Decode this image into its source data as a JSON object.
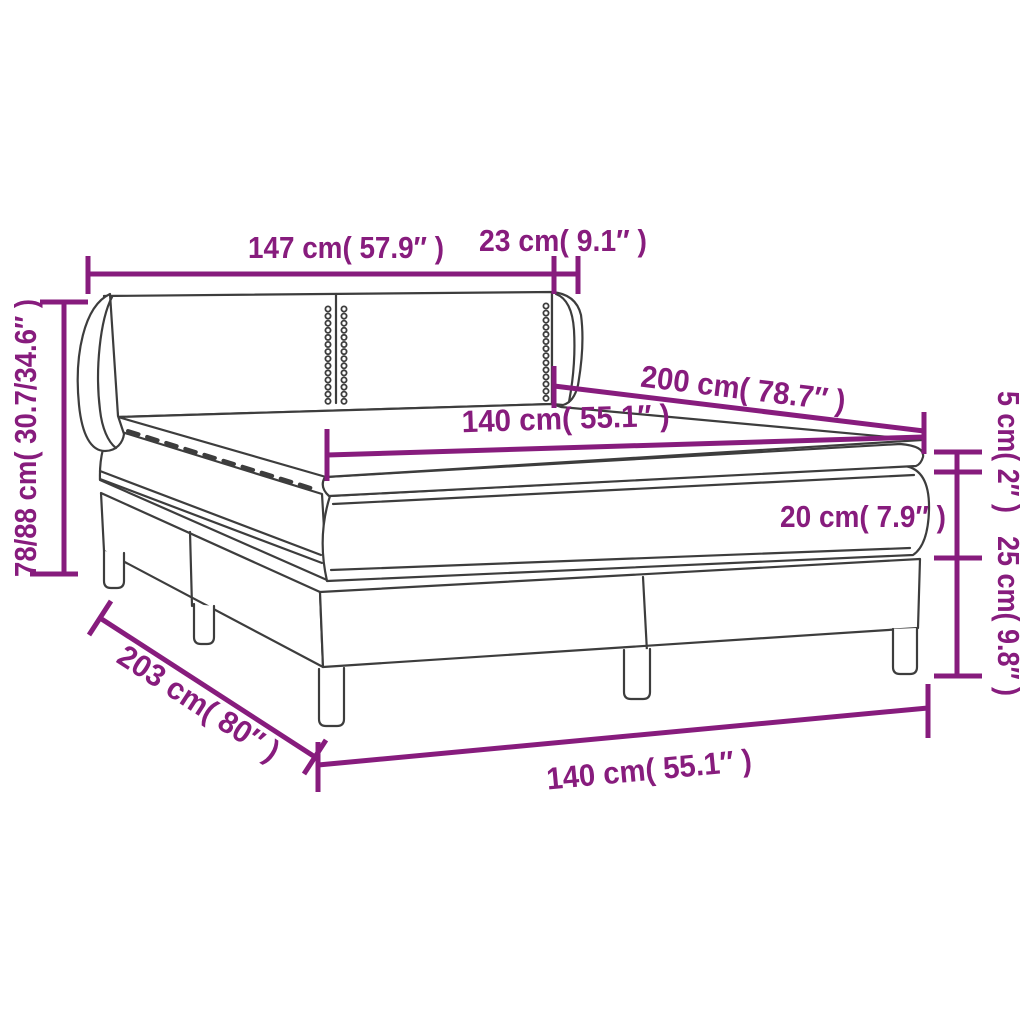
{
  "colors": {
    "dimension_accent": "#871C7D",
    "line_art": "#3D3D3D",
    "background": "#FFFFFF"
  },
  "diagram": {
    "subject": "box spring bed with headboard, mattress and topper",
    "labels": {
      "headboard_width": "147 cm( 57.9″ )",
      "headboard_side_depth": "23 cm( 9.1″ )",
      "overall_height": "78/88 cm( 30.7/34.6″ )",
      "bed_length": "200 cm( 78.7″ )",
      "mattress_width": "140 cm( 55.1″ )",
      "topper_height": "5 cm( 2″ )",
      "mattress_height": "20 cm( 7.9″ )",
      "box_height": "25 cm( 9.8″ )",
      "frame_length": "203 cm( 80″ )",
      "frame_width": "140 cm( 55.1″ )"
    }
  }
}
